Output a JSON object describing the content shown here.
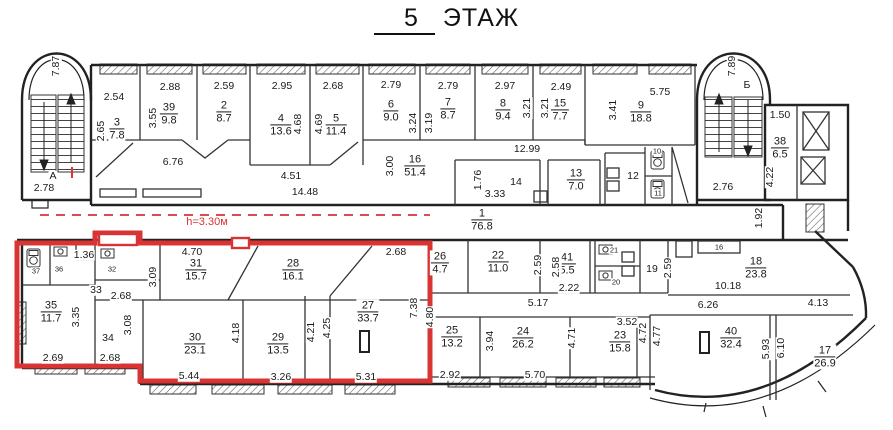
{
  "title": {
    "floor_number": "5",
    "floor_word": "ЭТАЖ"
  },
  "red_zone": {
    "height_note": "h=3.30м",
    "color": "#d93434"
  },
  "stairwells": {
    "left_label": "А",
    "right_label": "Б"
  },
  "rooms": [
    {
      "n": "3",
      "a": "7.8",
      "x": 117,
      "y": 129
    },
    {
      "n": "39",
      "a": "9.8",
      "x": 169,
      "y": 114
    },
    {
      "n": "2",
      "a": "8.7",
      "x": 224,
      "y": 112
    },
    {
      "n": "4",
      "a": "13.6",
      "x": 281,
      "y": 125
    },
    {
      "n": "5",
      "a": "11.4",
      "x": 336,
      "y": 125
    },
    {
      "n": "6",
      "a": "9.0",
      "x": 391,
      "y": 111
    },
    {
      "n": "7",
      "a": "8.7",
      "x": 448,
      "y": 109
    },
    {
      "n": "8",
      "a": "9.4",
      "x": 503,
      "y": 110
    },
    {
      "n": "15",
      "a": "7.7",
      "x": 560,
      "y": 110
    },
    {
      "n": "9",
      "a": "18.8",
      "x": 641,
      "y": 112
    },
    {
      "n": "16",
      "a": "51.4",
      "x": 415,
      "y": 166
    },
    {
      "n": "13",
      "a": "7.0",
      "x": 576,
      "y": 180
    },
    {
      "n": "1",
      "a": "76.8",
      "x": 482,
      "y": 220
    },
    {
      "n": "38",
      "a": "6.5",
      "x": 780,
      "y": 148
    },
    {
      "n": "35",
      "a": "11.7",
      "x": 51,
      "y": 312
    },
    {
      "n": "31",
      "a": "15.7",
      "x": 196,
      "y": 270
    },
    {
      "n": "28",
      "a": "16.1",
      "x": 293,
      "y": 270
    },
    {
      "n": "30",
      "a": "23.1",
      "x": 195,
      "y": 344
    },
    {
      "n": "29",
      "a": "13.5",
      "x": 278,
      "y": 344
    },
    {
      "n": "27",
      "a": "33.7",
      "x": 368,
      "y": 312
    },
    {
      "n": "26",
      "a": "4.7",
      "x": 440,
      "y": 263
    },
    {
      "n": "22",
      "a": "11.0",
      "x": 498,
      "y": 262
    },
    {
      "n": "41",
      "a": "5.5",
      "x": 567,
      "y": 264
    },
    {
      "n": "18",
      "a": "23.8",
      "x": 756,
      "y": 268
    },
    {
      "n": "25",
      "a": "13.2",
      "x": 452,
      "y": 337
    },
    {
      "n": "24",
      "a": "26.2",
      "x": 523,
      "y": 338
    },
    {
      "n": "23",
      "a": "15.8",
      "x": 620,
      "y": 342
    },
    {
      "n": "40",
      "a": "32.4",
      "x": 731,
      "y": 338
    },
    {
      "n": "17",
      "a": "26.9",
      "x": 825,
      "y": 357
    }
  ],
  "texts": [
    {
      "t": "2.54",
      "x": 114,
      "y": 97
    },
    {
      "t": "2.88",
      "x": 170,
      "y": 87
    },
    {
      "t": "2.59",
      "x": 224,
      "y": 86
    },
    {
      "t": "2.95",
      "x": 282,
      "y": 86
    },
    {
      "t": "2.68",
      "x": 333,
      "y": 86
    },
    {
      "t": "2.79",
      "x": 391,
      "y": 85
    },
    {
      "t": "2.79",
      "x": 448,
      "y": 86
    },
    {
      "t": "2.97",
      "x": 505,
      "y": 86
    },
    {
      "t": "2.49",
      "x": 561,
      "y": 87
    },
    {
      "t": "5.75",
      "x": 660,
      "y": 92
    },
    {
      "t": "2.65",
      "x": 101,
      "y": 131,
      "r": 270
    },
    {
      "t": "3.55",
      "x": 153,
      "y": 118,
      "r": 270
    },
    {
      "t": "4.68",
      "x": 298,
      "y": 124,
      "r": 270
    },
    {
      "t": "4.69",
      "x": 319,
      "y": 124,
      "r": 270
    },
    {
      "t": "3.24",
      "x": 413,
      "y": 123,
      "r": 270
    },
    {
      "t": "3.19",
      "x": 429,
      "y": 123,
      "r": 270
    },
    {
      "t": "3.21",
      "x": 527,
      "y": 108,
      "r": 270
    },
    {
      "t": "3.21",
      "x": 545,
      "y": 108,
      "r": 270
    },
    {
      "t": "3.41",
      "x": 613,
      "y": 110,
      "r": 270
    },
    {
      "t": "6.76",
      "x": 173,
      "y": 162
    },
    {
      "t": "4.51",
      "x": 291,
      "y": 176
    },
    {
      "t": "14.48",
      "x": 305,
      "y": 192
    },
    {
      "t": "3.00",
      "x": 390,
      "y": 166,
      "r": 270
    },
    {
      "t": "12.99",
      "x": 527,
      "y": 149
    },
    {
      "t": "1.76",
      "x": 478,
      "y": 180,
      "r": 270
    },
    {
      "t": "14",
      "x": 516,
      "y": 182
    },
    {
      "t": "3.33",
      "x": 495,
      "y": 194
    },
    {
      "t": "12",
      "x": 633,
      "y": 176
    },
    {
      "t": "10",
      "x": 657,
      "y": 151,
      "s": 1
    },
    {
      "t": "11",
      "x": 658,
      "y": 193,
      "s": 1
    },
    {
      "t": "7.87",
      "x": 56,
      "y": 66,
      "r": 270
    },
    {
      "t": "А",
      "x": 53,
      "y": 176
    },
    {
      "t": "2.78",
      "x": 44,
      "y": 188
    },
    {
      "t": "7.89",
      "x": 732,
      "y": 66,
      "r": 270
    },
    {
      "t": "Б",
      "x": 747,
      "y": 85
    },
    {
      "t": "2.76",
      "x": 723,
      "y": 187
    },
    {
      "t": "1.50",
      "x": 780,
      "y": 115
    },
    {
      "t": "4.22",
      "x": 770,
      "y": 177,
      "r": 270
    },
    {
      "t": "1.92",
      "x": 759,
      "y": 218,
      "r": 270
    },
    {
      "t": "1.36",
      "x": 84,
      "y": 255
    },
    {
      "t": "37",
      "x": 36,
      "y": 271,
      "s": 1
    },
    {
      "t": "36",
      "x": 59,
      "y": 269,
      "s": 1
    },
    {
      "t": "32",
      "x": 112,
      "y": 269,
      "s": 1
    },
    {
      "t": "33",
      "x": 96,
      "y": 290
    },
    {
      "t": "2.68",
      "x": 121,
      "y": 296
    },
    {
      "t": "3.09",
      "x": 153,
      "y": 277,
      "r": 270
    },
    {
      "t": "3.35",
      "x": 76,
      "y": 317,
      "r": 270
    },
    {
      "t": "2.69",
      "x": 53,
      "y": 358
    },
    {
      "t": "34",
      "x": 108,
      "y": 338
    },
    {
      "t": "3.08",
      "x": 128,
      "y": 325,
      "r": 270
    },
    {
      "t": "2.68",
      "x": 110,
      "y": 358
    },
    {
      "t": "4.70",
      "x": 192,
      "y": 252
    },
    {
      "t": "2.68",
      "x": 396,
      "y": 252
    },
    {
      "t": "5.44",
      "x": 189,
      "y": 376
    },
    {
      "t": "3.26",
      "x": 281,
      "y": 377
    },
    {
      "t": "5.31",
      "x": 366,
      "y": 377
    },
    {
      "t": "4.18",
      "x": 236,
      "y": 333,
      "r": 270
    },
    {
      "t": "4.21",
      "x": 311,
      "y": 332,
      "r": 270
    },
    {
      "t": "4.25",
      "x": 327,
      "y": 328,
      "r": 270
    },
    {
      "t": "7.38",
      "x": 414,
      "y": 308,
      "r": 270
    },
    {
      "t": "4.80",
      "x": 430,
      "y": 317,
      "r": 270
    },
    {
      "t": "2.92",
      "x": 450,
      "y": 375
    },
    {
      "t": "3.94",
      "x": 490,
      "y": 341,
      "r": 270
    },
    {
      "t": "5.17",
      "x": 538,
      "y": 303
    },
    {
      "t": "5.70",
      "x": 535,
      "y": 375
    },
    {
      "t": "4.71",
      "x": 572,
      "y": 338,
      "r": 270
    },
    {
      "t": "3.52",
      "x": 627,
      "y": 322
    },
    {
      "t": "4.72",
      "x": 643,
      "y": 333,
      "r": 270
    },
    {
      "t": "4.77",
      "x": 657,
      "y": 336,
      "r": 270
    },
    {
      "t": "2.59",
      "x": 538,
      "y": 265,
      "r": 270
    },
    {
      "t": "2.58",
      "x": 556,
      "y": 267,
      "r": 270
    },
    {
      "t": "2.22",
      "x": 569,
      "y": 288
    },
    {
      "t": "21",
      "x": 614,
      "y": 250,
      "s": 1
    },
    {
      "t": "20",
      "x": 616,
      "y": 282,
      "s": 1
    },
    {
      "t": "19",
      "x": 652,
      "y": 269
    },
    {
      "t": "2.59",
      "x": 668,
      "y": 268,
      "r": 270
    },
    {
      "t": "16",
      "x": 719,
      "y": 247,
      "s": 1
    },
    {
      "t": "10.18",
      "x": 728,
      "y": 286
    },
    {
      "t": "6.26",
      "x": 708,
      "y": 305
    },
    {
      "t": "4.13",
      "x": 818,
      "y": 303
    },
    {
      "t": "5.93",
      "x": 766,
      "y": 349,
      "r": 270
    },
    {
      "t": "6.10",
      "x": 781,
      "y": 348,
      "r": 270
    }
  ]
}
